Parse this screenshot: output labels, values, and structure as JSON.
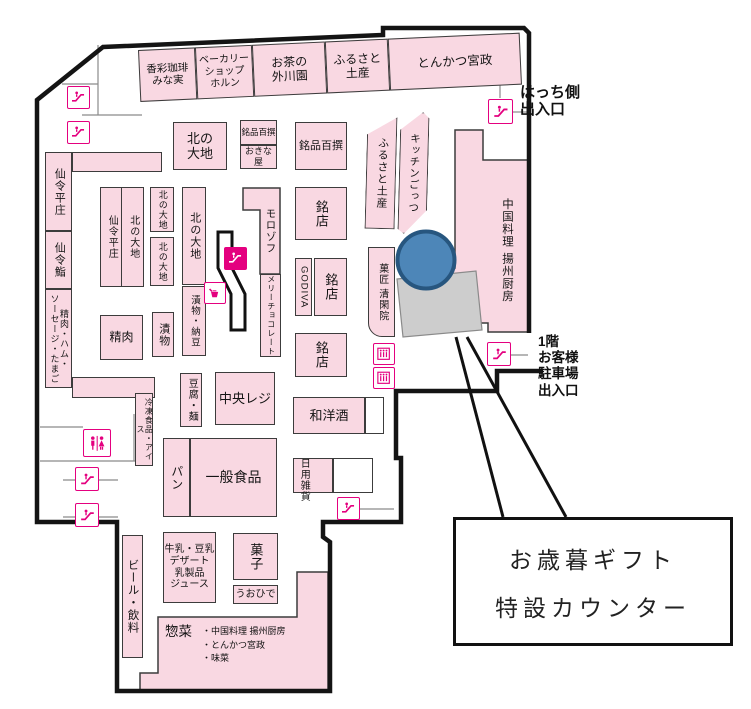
{
  "map": {
    "accent_color": "#e4007f",
    "room_fill_color": "#f9d8e2",
    "highlight_circle_color": "#4d86b8",
    "gift_counter_area_color": "#cdcdcd",
    "top_strip_rooms": [
      {
        "id": "kosai-coffee-minami",
        "label": "香彩珈琲\nみな実",
        "x": 0,
        "w": 57,
        "fs": 10.5
      },
      {
        "id": "bakery-shop-horn",
        "label": "ベーカリー\nショップ\nホルン",
        "x": 57,
        "w": 57,
        "fs": 10
      },
      {
        "id": "ocha-togawaen",
        "label": "お茶の\n外川園",
        "x": 114,
        "w": 73,
        "fs": 12
      },
      {
        "id": "furusato-miyage-top",
        "label": "ふるさと\n土産",
        "x": 187,
        "w": 63,
        "fs": 12
      },
      {
        "id": "tonkatsu-miyamasa",
        "label": "とんかつ宮政",
        "x": 250,
        "w": 132,
        "fs": 12.5
      }
    ],
    "rooms": [
      {
        "id": "kita-no-daichi-main",
        "label": "北の\n大地",
        "x": 173,
        "y": 122,
        "w": 54,
        "h": 48,
        "fs": 13
      },
      {
        "id": "meihin-hyakusen-mini",
        "label": "銘品百撰",
        "x": 240,
        "y": 120,
        "w": 37,
        "h": 25,
        "fs": 8.5
      },
      {
        "id": "okinaya",
        "label": "おきな屋",
        "x": 240,
        "y": 145,
        "w": 37,
        "h": 24,
        "fs": 9
      },
      {
        "id": "meihin-hyakusen",
        "label": "銘品百撰",
        "x": 295,
        "y": 122,
        "w": 52,
        "h": 48,
        "fs": 11
      },
      {
        "id": "senrei-heisho-wall",
        "label": "仙令平庄",
        "x": 45,
        "y": 152,
        "w": 27,
        "h": 79,
        "fs": 11,
        "mode": "v"
      },
      {
        "id": "senrei-arm-top",
        "label": "",
        "x": 72,
        "y": 152,
        "w": 90,
        "h": 20
      },
      {
        "id": "senrei-zushi",
        "label": "仙令鮨",
        "x": 45,
        "y": 231,
        "w": 27,
        "h": 58,
        "fs": 11,
        "mode": "v"
      },
      {
        "id": "meat-ham-sausage-eggs",
        "label": "精肉・ハム・\nソーセージ・たまご",
        "x": 45,
        "y": 289,
        "w": 27,
        "h": 99,
        "fs": 9,
        "mode": "v"
      },
      {
        "id": "senrei-arm-bottom",
        "label": "",
        "x": 72,
        "y": 377,
        "w": 83,
        "h": 21
      },
      {
        "id": "senrei-heisho-inner",
        "label": "仙令平庄",
        "x": 100,
        "y": 187,
        "w": 22,
        "h": 100,
        "fs": 10,
        "mode": "v"
      },
      {
        "id": "kita-no-daichi-col",
        "label": "北の大地",
        "x": 121,
        "y": 187,
        "w": 23,
        "h": 100,
        "fs": 10,
        "mode": "v"
      },
      {
        "id": "kita-no-daichi-s1",
        "label": "北の大地",
        "x": 150,
        "y": 187,
        "w": 24,
        "h": 45,
        "fs": 9,
        "mode": "v"
      },
      {
        "id": "kita-no-daichi-s2",
        "label": "北の大地",
        "x": 150,
        "y": 237,
        "w": 24,
        "h": 49,
        "fs": 9,
        "mode": "v"
      },
      {
        "id": "kita-no-daichi-tall",
        "label": "北の大地",
        "x": 182,
        "y": 187,
        "w": 24,
        "h": 98,
        "fs": 11,
        "mode": "v"
      },
      {
        "id": "tsukemono-natto",
        "label": "漬物・納豆",
        "x": 182,
        "y": 286,
        "w": 24,
        "h": 70,
        "fs": 9.5,
        "mode": "v"
      },
      {
        "id": "seiniku",
        "label": "精肉",
        "x": 100,
        "y": 315,
        "w": 43,
        "h": 45,
        "fs": 12
      },
      {
        "id": "tsukemono",
        "label": "漬物",
        "x": 152,
        "y": 312,
        "w": 22,
        "h": 45,
        "fs": 11,
        "mode": "v"
      },
      {
        "id": "mary-chocolate",
        "label": "メリーチョコレート",
        "x": 260,
        "y": 274,
        "w": 21,
        "h": 83,
        "fs": 8,
        "mode": "v"
      },
      {
        "id": "meiten-1",
        "label": "銘店",
        "x": 295,
        "y": 187,
        "w": 52,
        "h": 53,
        "fs": 13,
        "mode": "v"
      },
      {
        "id": "godiva",
        "label": "GODIVA",
        "x": 295,
        "y": 258,
        "w": 17,
        "h": 58,
        "fs": 9.5,
        "mode": "v"
      },
      {
        "id": "meiten-2",
        "label": "銘店",
        "x": 314,
        "y": 258,
        "w": 33,
        "h": 58,
        "fs": 13,
        "mode": "v"
      },
      {
        "id": "meiten-3",
        "label": "銘店",
        "x": 295,
        "y": 333,
        "w": 52,
        "h": 44,
        "fs": 13,
        "mode": "v"
      },
      {
        "id": "furusato-miyage-col",
        "label": "ふるさと土産",
        "x": 366,
        "y": 117,
        "w": 30,
        "h": 112,
        "fs": 11,
        "mode": "v",
        "rot": 1.5,
        "clip": "polygon(0 16%,100% 0,100% 100%,0 100%)"
      },
      {
        "id": "kitchen-gottsu",
        "label": "キッチンごっつ",
        "x": 399,
        "y": 112,
        "w": 29,
        "h": 122,
        "fs": 10.5,
        "mode": "v",
        "rot": 1.5,
        "clip": "polygon(0 15%,78% 0,100% 5%,100% 80%,22% 100%,0 96%)"
      },
      {
        "id": "kasho-seikanin",
        "label": "菓匠 清閑院",
        "x": 368,
        "y": 247,
        "w": 27,
        "h": 90,
        "fs": 10,
        "mode": "v",
        "radius": "0 0 0 14px"
      },
      {
        "id": "tofu-men",
        "label": "豆腐・麺",
        "x": 180,
        "y": 373,
        "w": 22,
        "h": 54,
        "fs": 10,
        "mode": "v"
      },
      {
        "id": "chuo-reji",
        "label": "中央レジ",
        "x": 215,
        "y": 372,
        "w": 60,
        "h": 53,
        "fs": 13
      },
      {
        "id": "wayoshu",
        "label": "和洋酒",
        "x": 293,
        "y": 397,
        "w": 72,
        "h": 37,
        "fs": 13
      },
      {
        "id": "wayoshu-annex",
        "label": "",
        "x": 365,
        "y": 397,
        "w": 19,
        "h": 37,
        "cls": "white"
      },
      {
        "id": "pan",
        "label": "パン",
        "x": 163,
        "y": 438,
        "w": 27,
        "h": 79,
        "fs": 12,
        "mode": "v"
      },
      {
        "id": "ippan-shokuhin",
        "label": "一般食品",
        "x": 190,
        "y": 438,
        "w": 87,
        "h": 79,
        "fs": 14
      },
      {
        "id": "reito-ice",
        "label": "冷凍食品・アイス",
        "x": 135,
        "y": 393,
        "w": 18,
        "h": 73,
        "fs": 8,
        "mode": "v"
      },
      {
        "id": "nichiyo-zakka-room",
        "label": "",
        "x": 293,
        "y": 458,
        "w": 40,
        "h": 35
      },
      {
        "id": "nichiyo-zakka-annex",
        "label": "",
        "x": 333,
        "y": 458,
        "w": 40,
        "h": 35,
        "cls": "white"
      },
      {
        "id": "nichiyo-zakka-label",
        "label": "日用雑貨",
        "x": 295,
        "y": 449,
        "w": 16,
        "h": 62,
        "fs": 10,
        "mode": "v",
        "cls": "bare"
      },
      {
        "id": "gyunyu-dessert",
        "label": "牛乳・豆乳\nデザート\n乳製品\nジュース",
        "x": 163,
        "y": 532,
        "w": 53,
        "h": 71,
        "fs": 10
      },
      {
        "id": "kashi",
        "label": "菓子",
        "x": 233,
        "y": 533,
        "w": 45,
        "h": 47,
        "fs": 13,
        "mode": "v"
      },
      {
        "id": "uohide",
        "label": "うおひで",
        "x": 233,
        "y": 585,
        "w": 45,
        "h": 19,
        "fs": 10
      },
      {
        "id": "beer-inryo",
        "label": "ビール・飲料",
        "x": 122,
        "y": 535,
        "w": 21,
        "h": 123,
        "fs": 11.5,
        "mode": "v"
      },
      {
        "id": "chugoku-yoshu-chubo-label",
        "label": "中国料理 揚州厨房",
        "x": 498,
        "y": 166,
        "w": 18,
        "h": 168,
        "fs": 11.5,
        "mode": "v",
        "cls": "bare"
      },
      {
        "id": "morozoff-label",
        "label": "モロゾフ",
        "x": 261,
        "y": 191,
        "w": 18,
        "h": 80,
        "fs": 10.5,
        "mode": "v",
        "cls": "bare"
      }
    ],
    "sozai": {
      "title": "惣菜",
      "detail": "・中国料理 揚州厨房\n・とんかつ宮政\n・味菜"
    },
    "entrances": {
      "hatchi": "はっち側\n出入口",
      "parking": "1階\nお客様\n駐車場\n出入口"
    },
    "callout": {
      "line1": "お歳暮ギフト",
      "line2": "特設カウンター"
    },
    "icons": [
      {
        "type": "escalator",
        "name": "escalator-icon-topleft-1",
        "x": 67,
        "y": 86,
        "s": 23
      },
      {
        "type": "escalator",
        "name": "escalator-icon-topleft-2",
        "x": 67,
        "y": 121,
        "s": 23
      },
      {
        "type": "escalator",
        "name": "escalator-icon-center",
        "x": 224,
        "y": 247,
        "s": 23,
        "filled": true
      },
      {
        "type": "coffee",
        "name": "coffee-icon",
        "x": 204,
        "y": 282,
        "s": 22
      },
      {
        "type": "escalator",
        "name": "escalator-icon-hatchi",
        "x": 488,
        "y": 99,
        "s": 25
      },
      {
        "type": "escalator",
        "name": "escalator-icon-parking",
        "x": 487,
        "y": 342,
        "s": 24
      },
      {
        "type": "escalator",
        "name": "escalator-icon-zakka",
        "x": 337,
        "y": 497,
        "s": 23
      },
      {
        "type": "escalator",
        "name": "escalator-icon-left-1",
        "x": 75,
        "y": 467,
        "s": 24
      },
      {
        "type": "escalator",
        "name": "escalator-icon-left-2",
        "x": 75,
        "y": 503,
        "s": 24
      },
      {
        "type": "restroom",
        "name": "restroom-icon",
        "x": 83,
        "y": 429,
        "s": 28
      },
      {
        "type": "elevator",
        "name": "elevator-icon-1",
        "x": 373,
        "y": 343,
        "s": 22
      },
      {
        "type": "elevator",
        "name": "elevator-icon-2",
        "x": 373,
        "y": 367,
        "s": 22
      }
    ]
  }
}
